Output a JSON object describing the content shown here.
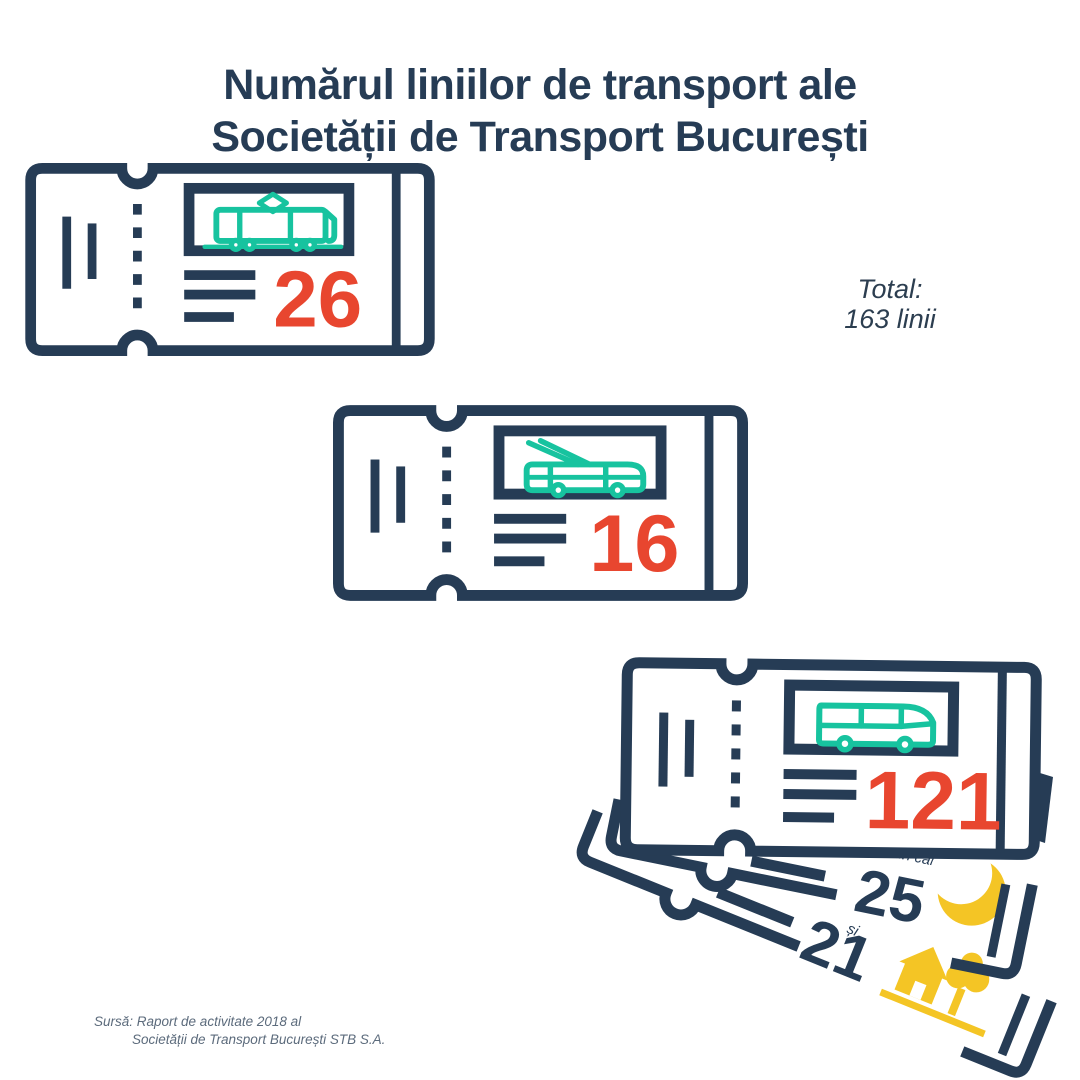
{
  "title": {
    "line1": "Numărul liniilor de transport ale",
    "line2": "Societății de Transport București"
  },
  "total": {
    "line1": "Total:",
    "line2": "163 linii"
  },
  "tickets": [
    {
      "id": "tram",
      "value": "26",
      "icon": "tram-icon"
    },
    {
      "id": "trolleybus",
      "value": "16",
      "icon": "trolleybus-icon"
    },
    {
      "id": "bus",
      "value": "121",
      "icon": "bus-icon"
    }
  ],
  "sub_tickets": [
    {
      "id": "night",
      "label": "din care",
      "value": "25",
      "icon": "moon-icon"
    },
    {
      "id": "regional",
      "label": "și",
      "value": "21",
      "icon": "house-tree-icon"
    }
  ],
  "source": {
    "line1": "Sursă: Raport de activitate 2018 al",
    "line2": "Societății de Transport București STB S.A."
  },
  "colors": {
    "navy": "#263C55",
    "teal": "#17C39F",
    "red": "#E8462F",
    "yellow": "#F4C525",
    "source_text": "#5C6B7C"
  },
  "chart_data": {
    "type": "bar",
    "title": "Numărul liniilor de transport ale Societății de Transport București",
    "categories": [
      "tram",
      "trolleybus",
      "bus"
    ],
    "values": [
      26,
      16,
      121
    ],
    "sub_values": [
      {
        "label": "din care",
        "value": 25,
        "icon": "moon (night lines)"
      },
      {
        "label": "și",
        "value": 21,
        "icon": "house-tree (suburban lines)"
      }
    ],
    "total": 163,
    "total_label": "Total: 163 linii",
    "source": "Sursă: Raport de activitate 2018 al Societății de Transport București STB S.A.",
    "legend_position": "none",
    "grid": false
  }
}
